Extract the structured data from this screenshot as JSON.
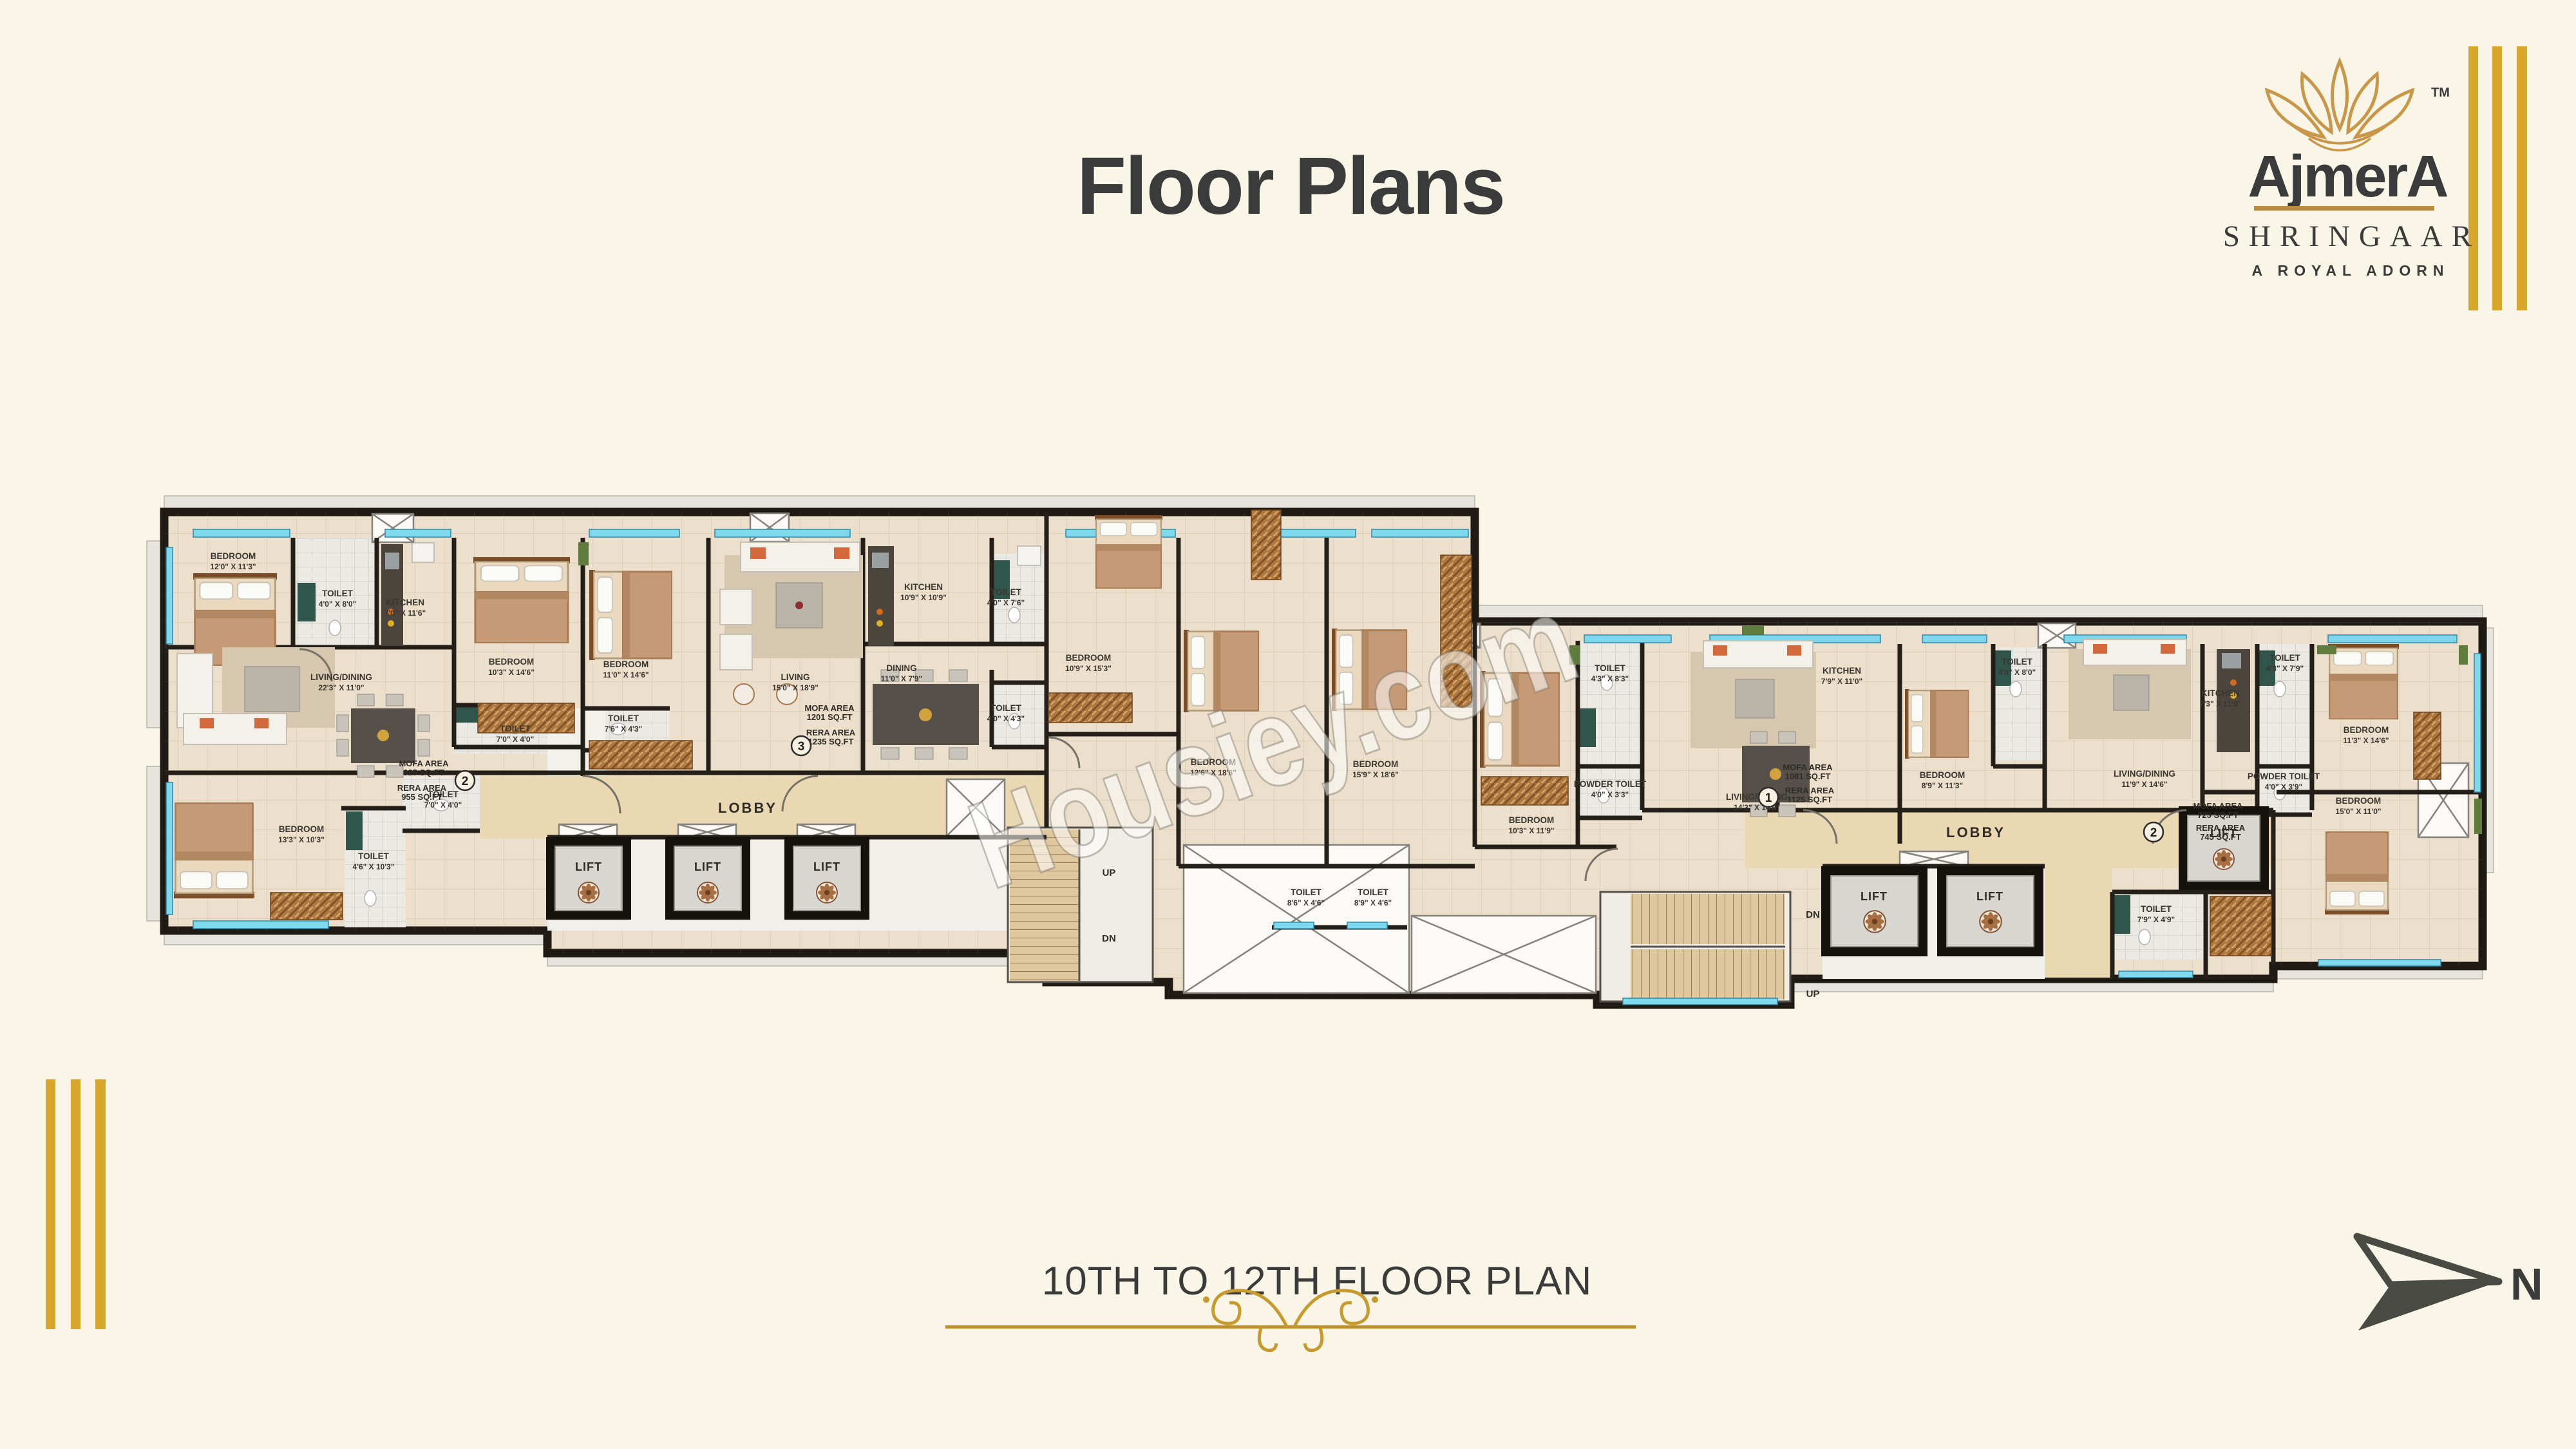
{
  "title": {
    "text": "Floor Plans"
  },
  "logo": {
    "brand": "AjmerA",
    "tm": "TM",
    "project": "SHRINGAAR",
    "tagline": "A ROYAL ADORN"
  },
  "caption": {
    "text": "10TH TO 12TH FLOOR PLAN"
  },
  "compass": {
    "north": "N"
  },
  "watermark": {
    "text": "Housiey.com"
  },
  "labels": {
    "lobby": "LOBBY",
    "lift": "LIFT",
    "up": "UP",
    "dn": "DN"
  },
  "colors": {
    "gold": "#c9992f",
    "stripe_gold": "#d7a62b",
    "wall": "#241f18",
    "window": "#7fd8ec",
    "floor": "#ece0cc",
    "lobby_floor": "#e9d8b2",
    "marble_green": "#30554a",
    "arrow_gray": "#4a4a45"
  },
  "units": [
    {
      "id": "2",
      "area_label_1": "MOFA AREA",
      "area_value_1": "925 SQ.FT",
      "area_label_2": "RERA AREA",
      "area_value_2": "955 SQ.FT"
    },
    {
      "id": "3",
      "area_label_1": "MOFA AREA",
      "area_value_1": "1201 SQ.FT",
      "area_label_2": "RERA AREA",
      "area_value_2": "1235 SQ.FT"
    },
    {
      "id": "1",
      "area_label_1": "MOFA AREA",
      "area_value_1": "1081 SQ.FT",
      "area_label_2": "RERA AREA",
      "area_value_2": "1125 SQ.FT"
    },
    {
      "id": "2",
      "area_label_1": "MOFA AREA",
      "area_value_1": "725 SQ.FT",
      "area_label_2": "RERA AREA",
      "area_value_2": "745 SQ.FT"
    }
  ],
  "rooms": [
    {
      "name": "BEDROOM",
      "dims": "12'0\" X 11'3\""
    },
    {
      "name": "TOILET",
      "dims": "4'0\" X 8'0\""
    },
    {
      "name": "KITCHEN",
      "dims": "7'0\" X 11'6\""
    },
    {
      "name": "BEDROOM",
      "dims": "10'3\" X 14'6\""
    },
    {
      "name": "LIVING/DINING",
      "dims": "22'3\" X 11'0\""
    },
    {
      "name": "TOILET",
      "dims": "7'0\" X 4'0\""
    },
    {
      "name": "TOILET",
      "dims": "7'0\" X 4'0\""
    },
    {
      "name": "BEDROOM",
      "dims": "13'3\" X 10'3\""
    },
    {
      "name": "TOILET",
      "dims": "4'6\" X 10'3\""
    },
    {
      "name": "BEDROOM",
      "dims": "11'0\" X 14'6\""
    },
    {
      "name": "TOILET",
      "dims": "7'6\" X 4'3\""
    },
    {
      "name": "LIVING",
      "dims": "15'0\" X 18'9\""
    },
    {
      "name": "KITCHEN",
      "dims": "10'9\" X 10'9\""
    },
    {
      "name": "DINING",
      "dims": "11'0\" X 7'9\""
    },
    {
      "name": "TOILET",
      "dims": "4'0\" X 7'6\""
    },
    {
      "name": "TOILET",
      "dims": "4'0\" X 4'3\""
    },
    {
      "name": "BEDROOM",
      "dims": "10'9\" X 15'3\""
    },
    {
      "name": "BEDROOM",
      "dims": "12'6\" X 18'6\""
    },
    {
      "name": "BEDROOM",
      "dims": "15'9\" X 18'6\""
    },
    {
      "name": "TOILET",
      "dims": "8'6\" X 4'6\""
    },
    {
      "name": "TOILET",
      "dims": "8'9\" X 4'6\""
    },
    {
      "name": "BEDROOM",
      "dims": "10'3\" X 11'9\""
    },
    {
      "name": "TOILET",
      "dims": "4'3\" X 8'3\""
    },
    {
      "name": "POWDER TOILET",
      "dims": "4'0\" X 3'3\""
    },
    {
      "name": "LIVING/DINING",
      "dims": "14'3\" X 14'6\""
    },
    {
      "name": "KITCHEN",
      "dims": "7'9\" X 11'0\""
    },
    {
      "name": "BEDROOM",
      "dims": "8'9\" X 11'3\""
    },
    {
      "name": "TOILET",
      "dims": "4'0\" X 8'0\""
    },
    {
      "name": "LIVING/DINING",
      "dims": "11'9\" X 14'6\""
    },
    {
      "name": "KITCHEN",
      "dims": "7'3\" X 11'9\""
    },
    {
      "name": "TOILET",
      "dims": "4'3\" X 7'9\""
    },
    {
      "name": "POWDER TOILET",
      "dims": "4'0\" X 3'9\""
    },
    {
      "name": "TOILET",
      "dims": "7'9\" X 4'9\""
    },
    {
      "name": "BEDROOM",
      "dims": "11'3\" X 14'6\""
    },
    {
      "name": "BEDROOM",
      "dims": "15'0\" X 11'0\""
    }
  ]
}
